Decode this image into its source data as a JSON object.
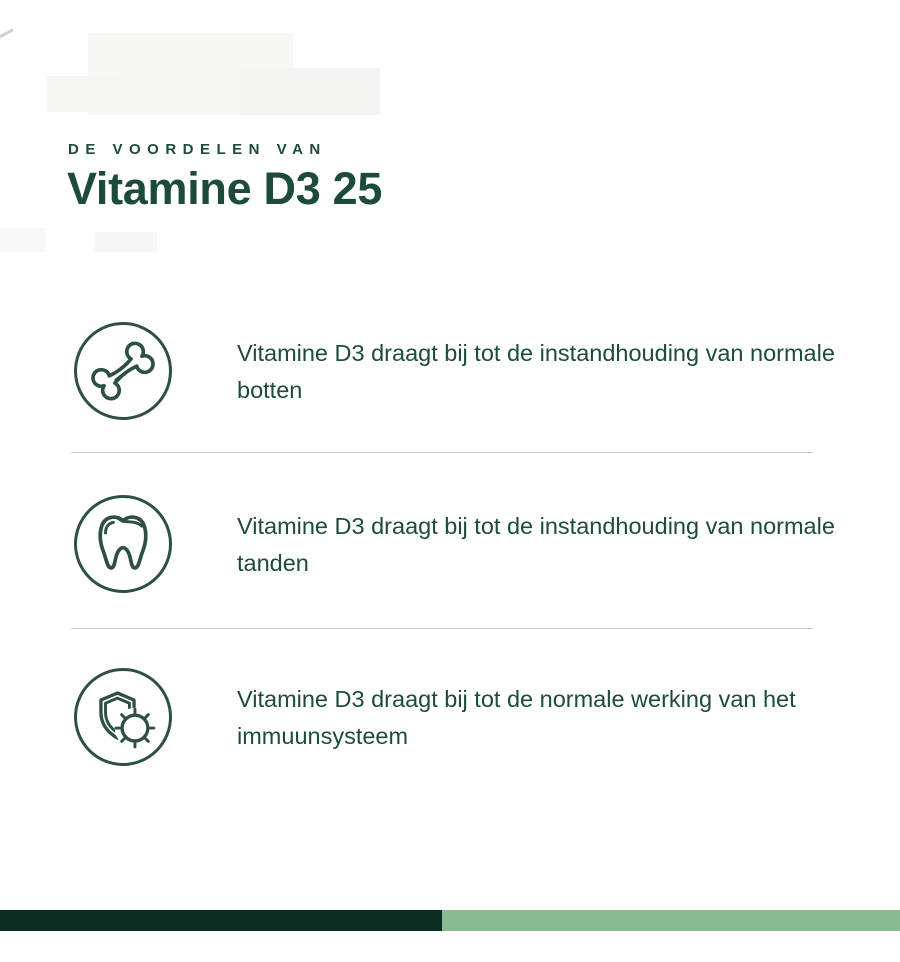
{
  "header": {
    "kicker": "DE VOORDELEN VAN",
    "title": "Vitamine D3 25"
  },
  "benefits": [
    {
      "icon": "bone-icon",
      "text": "Vitamine D3 draagt bij tot de instandhouding van normale botten"
    },
    {
      "icon": "tooth-icon",
      "text": "Vitamine D3 draagt bij tot de instandhouding van normale tanden"
    },
    {
      "icon": "shield-virus-icon",
      "text": "Vitamine D3 draagt bij tot de normale werking van het immuunsysteem"
    }
  ],
  "colors": {
    "heading_green": "#1c4b3c",
    "body_green": "#1d4b3e",
    "icon_green": "#2e5044",
    "divider_gray": "#c9c9c5",
    "footer_dark_green": "#0a2e21",
    "footer_light_green": "#8bba92",
    "background": "#ffffff"
  }
}
